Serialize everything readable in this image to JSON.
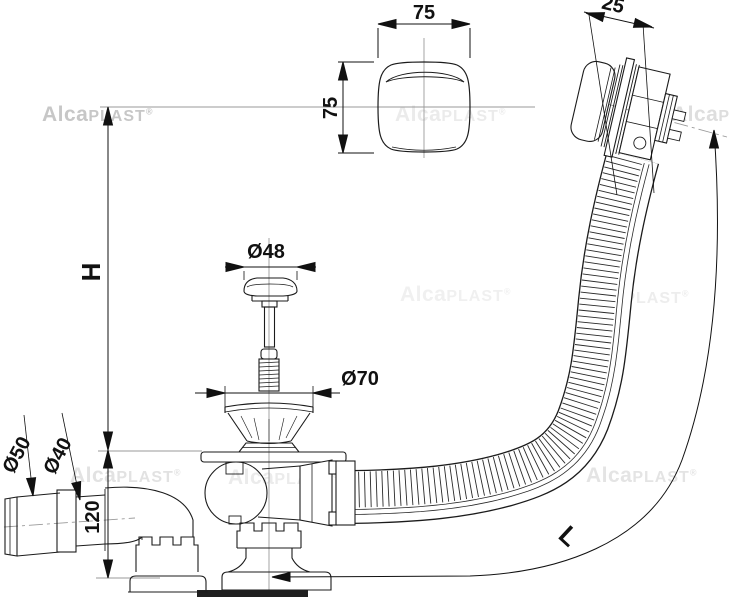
{
  "watermark": {
    "part1": "Alca",
    "part2": "PLAST",
    "reg": "®"
  },
  "dimensions": {
    "knob_width": "75",
    "knob_height": "75",
    "overflow_depth": "25",
    "plug_diameter": "Ø48",
    "strainer_diameter": "Ø70",
    "install_height": "H",
    "outlet_outer_diameter": "Ø50",
    "outlet_inner_diameter": "Ø40",
    "base_height": "120",
    "hose_length": "L"
  }
}
